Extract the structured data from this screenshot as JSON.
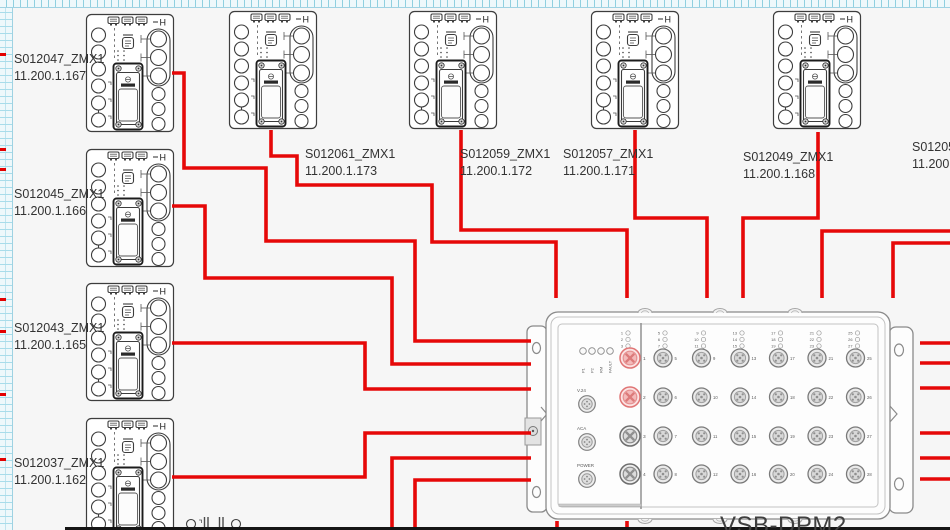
{
  "zmx_h": "H",
  "devices": [
    {
      "name": "S012047_ZMX1",
      "ip": "11.200.1.167",
      "x": 85,
      "y": 13,
      "lx": 14,
      "ly": 51
    },
    {
      "name": "S012045_ZMX1",
      "ip": "11.200.1.166",
      "x": 85,
      "y": 148,
      "lx": 14,
      "ly": 186
    },
    {
      "name": "S012043_ZMX1",
      "ip": "11.200.1.165",
      "x": 85,
      "y": 282,
      "lx": 14,
      "ly": 320
    },
    {
      "name": "S012037_ZMX1",
      "ip": "11.200.1.162",
      "x": 85,
      "y": 417,
      "lx": 14,
      "ly": 455
    },
    {
      "name": "S012061_ZMX1",
      "ip": "11.200.1.173",
      "x": 228,
      "y": 10,
      "lx": 305,
      "ly": 146
    },
    {
      "name": "S012059_ZMX1",
      "ip": "11.200.1.172",
      "x": 408,
      "y": 10,
      "lx": 460,
      "ly": 146
    },
    {
      "name": "S012057_ZMX1",
      "ip": "11.200.1.171",
      "x": 590,
      "y": 10,
      "lx": 563,
      "ly": 146
    },
    {
      "name": "S012049_ZMX1",
      "ip": "11.200.1.168",
      "x": 772,
      "y": 10,
      "lx": 743,
      "ly": 149
    }
  ],
  "partial_device_label": {
    "name": "S012053",
    "ip": "11.200.1",
    "lx": 912,
    "ly": 139
  },
  "switch": {
    "label": "VSB-DPM2",
    "status_leds": [
      "P1",
      "P2",
      "RM",
      "FAULT"
    ],
    "aux_ports": [
      "V.24",
      "ACA",
      "POWER"
    ],
    "led_groups": [
      [
        1,
        2,
        3,
        4
      ],
      [
        5,
        6,
        7,
        8
      ],
      [
        9,
        10,
        11,
        12
      ],
      [
        13,
        14,
        15,
        16
      ],
      [
        17,
        18,
        19,
        20
      ],
      [
        21,
        22,
        23,
        24
      ],
      [
        25,
        26,
        27,
        28
      ]
    ],
    "xcoded_ports": [
      1,
      2,
      3,
      4
    ],
    "highlighted_ports": [
      1,
      2
    ],
    "grid_ports": [
      [
        5,
        6,
        7,
        8
      ],
      [
        9,
        10,
        11,
        12
      ],
      [
        13,
        14,
        15,
        16
      ],
      [
        17,
        18,
        19,
        20
      ],
      [
        21,
        22,
        23,
        24
      ],
      [
        25,
        26,
        27,
        28
      ]
    ]
  },
  "wires": [
    [
      172,
      73,
      184,
      73,
      184,
      168,
      266,
      168,
      266,
      241,
      415,
      241,
      415,
      341,
      531,
      341
    ],
    [
      271,
      130,
      271,
      156,
      297,
      156,
      297,
      185,
      432,
      185,
      432,
      242,
      556,
      242,
      556,
      298
    ],
    [
      172,
      206,
      205,
      206,
      205,
      278,
      392,
      278,
      392,
      364,
      531,
      364
    ],
    [
      172,
      343,
      365,
      343,
      365,
      389,
      531,
      389
    ],
    [
      172,
      477,
      365,
      477,
      365,
      433,
      531,
      433
    ],
    [
      392,
      532,
      392,
      458,
      531,
      458
    ],
    [
      415,
      532,
      415,
      480,
      531,
      480
    ],
    [
      461,
      130,
      461,
      230,
      627,
      230,
      627,
      298
    ],
    [
      635,
      130,
      635,
      218,
      707,
      218,
      707,
      298
    ],
    [
      818,
      132,
      818,
      218,
      743,
      218,
      743,
      298
    ],
    [
      952,
      231,
      822,
      231,
      822,
      298
    ],
    [
      952,
      243,
      893,
      243,
      893,
      298
    ],
    [
      952,
      343,
      920,
      343
    ],
    [
      952,
      363,
      920,
      363
    ],
    [
      952,
      388,
      920,
      388
    ],
    [
      952,
      433,
      920,
      433
    ],
    [
      952,
      458,
      920,
      458
    ],
    [
      952,
      479,
      920,
      479
    ],
    [
      557,
      521,
      557,
      532
    ],
    [
      627,
      521,
      627,
      532
    ]
  ],
  "ruler_red_ticks": [
    53,
    148,
    168,
    298,
    330,
    393,
    458
  ],
  "colors": {
    "wire": "#e60808",
    "hl_stroke": "#e07575",
    "hl_fill": "#fbe3e3",
    "hl_mid": "#f3baba",
    "hl_x": "#dc7a7a"
  }
}
